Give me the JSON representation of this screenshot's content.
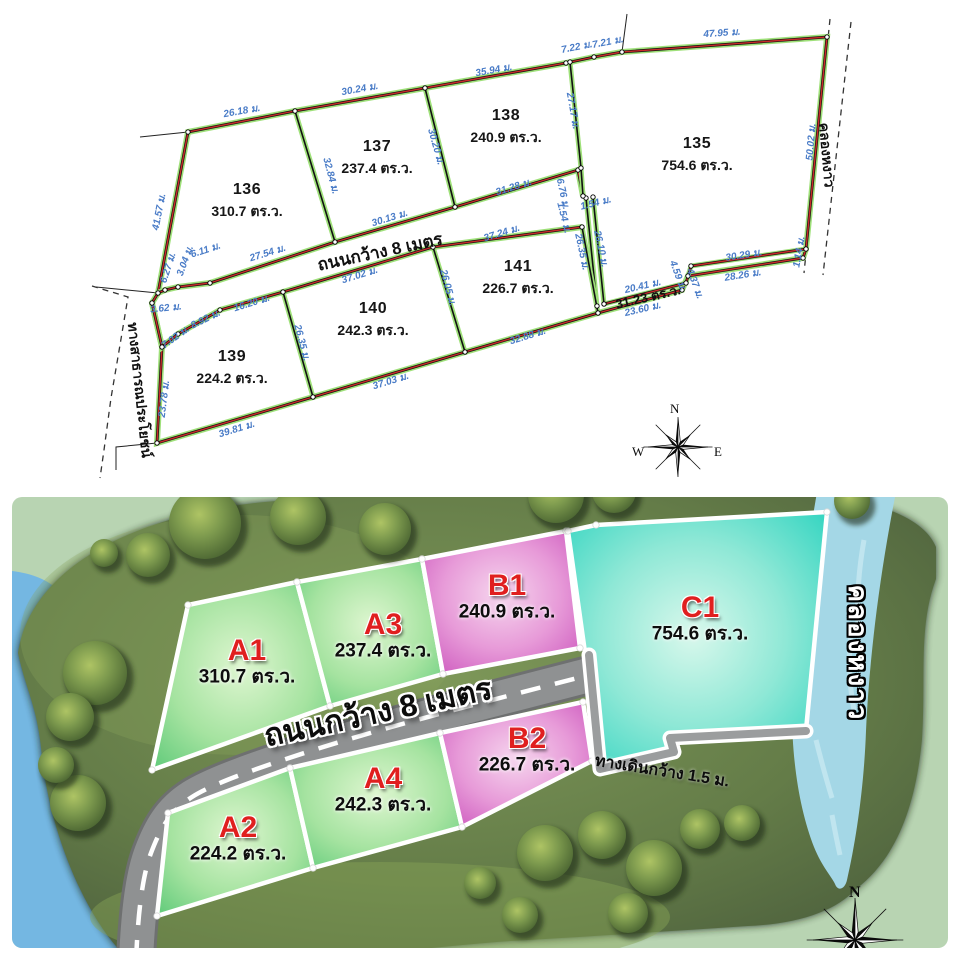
{
  "top_plan": {
    "plots": [
      {
        "id": "136",
        "area": "310.7 ตร.ว.",
        "lx": 247,
        "ly": 190
      },
      {
        "id": "137",
        "area": "237.4 ตร.ว.",
        "lx": 377,
        "ly": 147
      },
      {
        "id": "138",
        "area": "240.9 ตร.ว.",
        "lx": 506,
        "ly": 116
      },
      {
        "id": "135",
        "area": "754.6 ตร.ว.",
        "lx": 697,
        "ly": 144
      },
      {
        "id": "139",
        "area": "224.2 ตร.ว.",
        "lx": 232,
        "ly": 357
      },
      {
        "id": "140",
        "area": "242.3 ตร.ว.",
        "lx": 373,
        "ly": 309
      },
      {
        "id": "141",
        "area": "226.7 ตร.ว.",
        "lx": 518,
        "ly": 267
      }
    ],
    "strip_label": {
      "text": "31.23 ตร.ว.",
      "x": 648,
      "y": 297,
      "rot": -13
    },
    "road_label": {
      "text": "ถนนกว้าง 8 เมตร",
      "x": 380,
      "y": 252,
      "rot": -12
    },
    "public_road_label": {
      "text": "ทางสาธารณประโยชน์",
      "x": 140,
      "y": 390,
      "rot": 84
    },
    "canal_label": {
      "text": "คลองหงาว",
      "x": 827,
      "y": 155,
      "rot": 85
    },
    "compass": {
      "n": "N",
      "w": "W",
      "e": "E"
    },
    "dim_color": "#4a7cc7",
    "dimensions": [
      {
        "t": "26.18 ม.",
        "x": 242,
        "y": 112,
        "r": -10
      },
      {
        "t": "30.24 ม.",
        "x": 360,
        "y": 90,
        "r": -10
      },
      {
        "t": "35.94 ม.",
        "x": 494,
        "y": 71,
        "r": -10
      },
      {
        "t": "7.22 ม.",
        "x": 577,
        "y": 48,
        "r": -11
      },
      {
        "t": "7.21 ม.",
        "x": 608,
        "y": 43,
        "r": -11
      },
      {
        "t": "47.95 ม.",
        "x": 722,
        "y": 34,
        "r": -4
      },
      {
        "t": "50.02 ม.",
        "x": 812,
        "y": 142,
        "r": -85
      },
      {
        "t": "41.57 ม.",
        "x": 160,
        "y": 212,
        "r": -79
      },
      {
        "t": "6.27 ม.",
        "x": 169,
        "y": 268,
        "r": -72
      },
      {
        "t": "3.04 ม.",
        "x": 186,
        "y": 261,
        "r": -70
      },
      {
        "t": "6.11 ม.",
        "x": 206,
        "y": 251,
        "r": -18
      },
      {
        "t": "27.54 ม.",
        "x": 268,
        "y": 254,
        "r": -17
      },
      {
        "t": "30.13 ม.",
        "x": 390,
        "y": 219,
        "r": -17
      },
      {
        "t": "31.28 ม.",
        "x": 514,
        "y": 188,
        "r": -17
      },
      {
        "t": "32.84 ม.",
        "x": 330,
        "y": 176,
        "r": 75
      },
      {
        "t": "30.20 ม.",
        "x": 435,
        "y": 147,
        "r": 74
      },
      {
        "t": "27.17 ม.",
        "x": 572,
        "y": 111,
        "r": 80
      },
      {
        "t": "6.76 ม.",
        "x": 562,
        "y": 194,
        "r": 78
      },
      {
        "t": "1.54 ม.",
        "x": 563,
        "y": 218,
        "r": 76
      },
      {
        "t": "1.54 ม.",
        "x": 596,
        "y": 204,
        "r": -14
      },
      {
        "t": "26.35 ม.",
        "x": 581,
        "y": 252,
        "r": 78
      },
      {
        "t": "26.10 ม.",
        "x": 600,
        "y": 249,
        "r": 78
      },
      {
        "t": "37.24 ม.",
        "x": 502,
        "y": 234,
        "r": -17
      },
      {
        "t": "26.05 ม.",
        "x": 447,
        "y": 288,
        "r": 75
      },
      {
        "t": "37.02 ม.",
        "x": 360,
        "y": 276,
        "r": -17
      },
      {
        "t": "16.20 ม.",
        "x": 252,
        "y": 304,
        "r": -17
      },
      {
        "t": "8.92 ม.",
        "x": 206,
        "y": 320,
        "r": -26
      },
      {
        "t": "7.02 ม.",
        "x": 176,
        "y": 338,
        "r": -36
      },
      {
        "t": "3.62 ม.",
        "x": 166,
        "y": 309,
        "r": -6
      },
      {
        "t": "26.35 ม.",
        "x": 301,
        "y": 343,
        "r": 75
      },
      {
        "t": "23.78 ม.",
        "x": 165,
        "y": 399,
        "r": -83
      },
      {
        "t": "39.81 ม.",
        "x": 237,
        "y": 430,
        "r": -17
      },
      {
        "t": "37.03 ม.",
        "x": 391,
        "y": 382,
        "r": -17
      },
      {
        "t": "32.88 ม.",
        "x": 528,
        "y": 337,
        "r": -17
      },
      {
        "t": "20.41 ม.",
        "x": 643,
        "y": 287,
        "r": -13
      },
      {
        "t": "23.60 ม.",
        "x": 643,
        "y": 310,
        "r": -13
      },
      {
        "t": "4.59 ม.",
        "x": 677,
        "y": 276,
        "r": 70
      },
      {
        "t": "4.37 ม.",
        "x": 694,
        "y": 284,
        "r": 70
      },
      {
        "t": "30.29 ม.",
        "x": 744,
        "y": 256,
        "r": -9
      },
      {
        "t": "28.26 ม.",
        "x": 743,
        "y": 276,
        "r": -9
      },
      {
        "t": "1.14 ม.",
        "x": 800,
        "y": 252,
        "r": -80
      }
    ]
  },
  "site_map": {
    "plots": [
      {
        "id": "A1",
        "area": "310.7 ตร.ว.",
        "x": 247,
        "y": 651
      },
      {
        "id": "A3",
        "area": "237.4 ตร.ว.",
        "x": 383,
        "y": 625
      },
      {
        "id": "B1",
        "area": "240.9 ตร.ว.",
        "x": 507,
        "y": 586
      },
      {
        "id": "C1",
        "area": "754.6 ตร.ว.",
        "x": 700,
        "y": 608
      },
      {
        "id": "A2",
        "area": "224.2 ตร.ว.",
        "x": 238,
        "y": 828
      },
      {
        "id": "A4",
        "area": "242.3 ตร.ว.",
        "x": 383,
        "y": 779
      },
      {
        "id": "B2",
        "area": "226.7 ตร.ว.",
        "x": 527,
        "y": 739
      }
    ],
    "road_label": {
      "text": "ถนนกว้าง 8 เมตร",
      "x": 378,
      "y": 712,
      "rot": -12
    },
    "walkway_label": {
      "text": "ทางเดินกว้าง 1.5 ม.",
      "x": 662,
      "y": 772,
      "rot": 9
    },
    "canal_label": {
      "text": "คลองหงาว",
      "x": 858,
      "y": 653,
      "rot": 90
    },
    "compass_n": "N",
    "colors": {
      "plot_a": "#5dc978",
      "plot_b": "#c94fba",
      "plot_c": "#30d4c0",
      "id_text": "#e01f1f",
      "road": "#8f9192",
      "water": "#a4d7e6",
      "land": "#5c7345",
      "bg": "#b8d4b2",
      "pond": "#74b7e2"
    }
  }
}
